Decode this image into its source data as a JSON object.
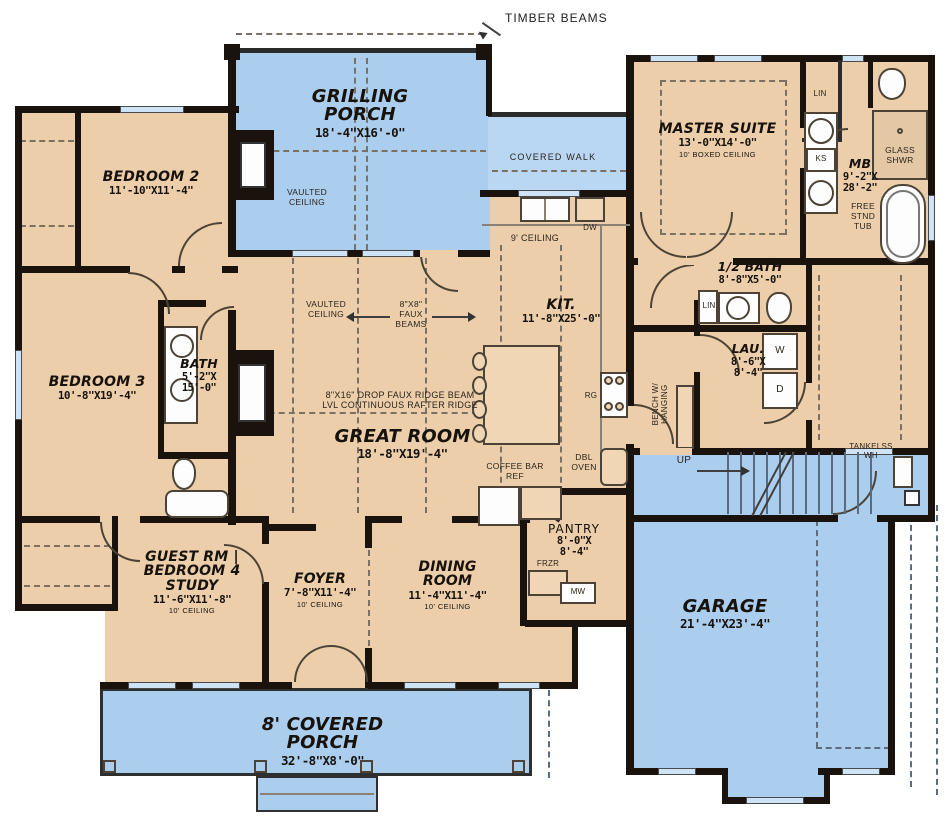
{
  "colors": {
    "floor_tan": "#ecceab",
    "porch_blue": "#abcdee",
    "wall_black": "#1a130d",
    "window_blue": "#cfe3f7"
  },
  "rooms": [
    {
      "id": "grilling-porch",
      "name": "GRILLING PORCH",
      "dims": "18'-4\"X16'-0\""
    },
    {
      "id": "master-suite",
      "name": "MASTER SUITE",
      "dims": "13'-0\"X14'-0\"",
      "note": "10' BOXED CEILING"
    },
    {
      "id": "master-bath",
      "name": "MB",
      "dims": "9'-2\"X\n28'-2\""
    },
    {
      "id": "bedroom-2",
      "name": "BEDROOM 2",
      "dims": "11'-10\"X11'-4\""
    },
    {
      "id": "bedroom-3",
      "name": "BEDROOM 3",
      "dims": "10'-8\"X19'-4\""
    },
    {
      "id": "bath",
      "name": "BATH",
      "dims": "5'-2\"X\n15'-0\""
    },
    {
      "id": "great-room",
      "name": "GREAT ROOM",
      "dims": "18'-8\"X19'-4\""
    },
    {
      "id": "kitchen",
      "name": "KIT.",
      "dims": "11'-8\"X25'-0\""
    },
    {
      "id": "half-bath",
      "name": "1/2 BATH",
      "dims": "8'-8\"X5'-0\""
    },
    {
      "id": "laundry",
      "name": "LAU.",
      "dims": "8'-6\"X\n8'-4\""
    },
    {
      "id": "pantry",
      "name": "PANTRY",
      "dims": "8'-0\"X\n8'-4\""
    },
    {
      "id": "guest-room",
      "name": "GUEST RM |\nBEDROOM 4\nSTUDY",
      "dims": "11'-6\"X11'-8\"",
      "note": "10' CEILING"
    },
    {
      "id": "foyer",
      "name": "FOYER",
      "dims": "7'-8\"X11'-4\"",
      "note": "10' CEILING"
    },
    {
      "id": "dining-room",
      "name": "DINING\nROOM",
      "dims": "11'-4\"X11'-4\"",
      "note": "10' CEILING"
    },
    {
      "id": "garage",
      "name": "GARAGE",
      "dims": "21'-4\"X23'-4\""
    },
    {
      "id": "covered-porch",
      "name": "8' COVERED PORCH",
      "dims": "32'-8\"X8'-0\""
    }
  ],
  "annotations": {
    "timber_beams": "TIMBER BEAMS",
    "covered_walk": "COVERED WALK",
    "vaulted_ceiling_porch": "VAULTED\nCEILING",
    "vaulted_ceiling_great": "VAULTED\nCEILING",
    "faux_beams": "8\"X8\"\nFAUX\nBEAMS",
    "ridge_beam": "8\"X16\" DROP FAUX RIDGE BEAM\nLVL CONTINUOUS RAFTER RIDGE",
    "ceiling_9": "9' CEILING",
    "coffee_bar": "COFFEE BAR\nREF",
    "dbl_oven": "DBL\nOVEN",
    "range": "RG",
    "dishwasher": "DW",
    "freezer": "FRZR",
    "microwave": "MW",
    "washer": "W",
    "dryer": "D",
    "lin_half_bath": "LIN",
    "lin_master": "LIN",
    "knee_space": "KS",
    "glass_shower": "GLASS\nSHWR",
    "free_stand_tub": "FREE\nSTND\nTUB",
    "bench": "BENCH W/\nHANGING",
    "stairs_up": "UP",
    "tankless_wh": "TANKELSS\nWH"
  }
}
